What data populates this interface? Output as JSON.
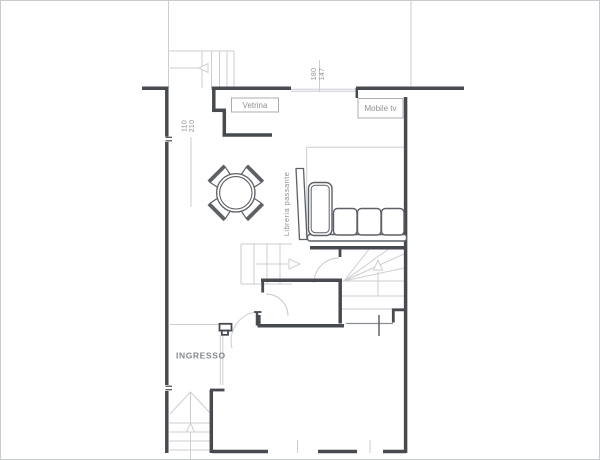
{
  "plan": {
    "title": "floor-plan",
    "labels": {
      "vetrina": "Vetrina",
      "mobile_tv": "Mobile tv",
      "libreria": "Libreria passante",
      "ingresso": "INGRESSO"
    },
    "dimensions": {
      "window_top_width": "180",
      "window_top_height": "147",
      "window_left_width": "110",
      "window_left_height": "210"
    },
    "colors": {
      "wall": "#474a4f",
      "furniture": "#5d6065",
      "light_line": "#ccced2",
      "arc": "#c6c9cd",
      "box_border": "#a9acb0",
      "label_text": "#8f9296",
      "background": "#ffffff"
    }
  }
}
